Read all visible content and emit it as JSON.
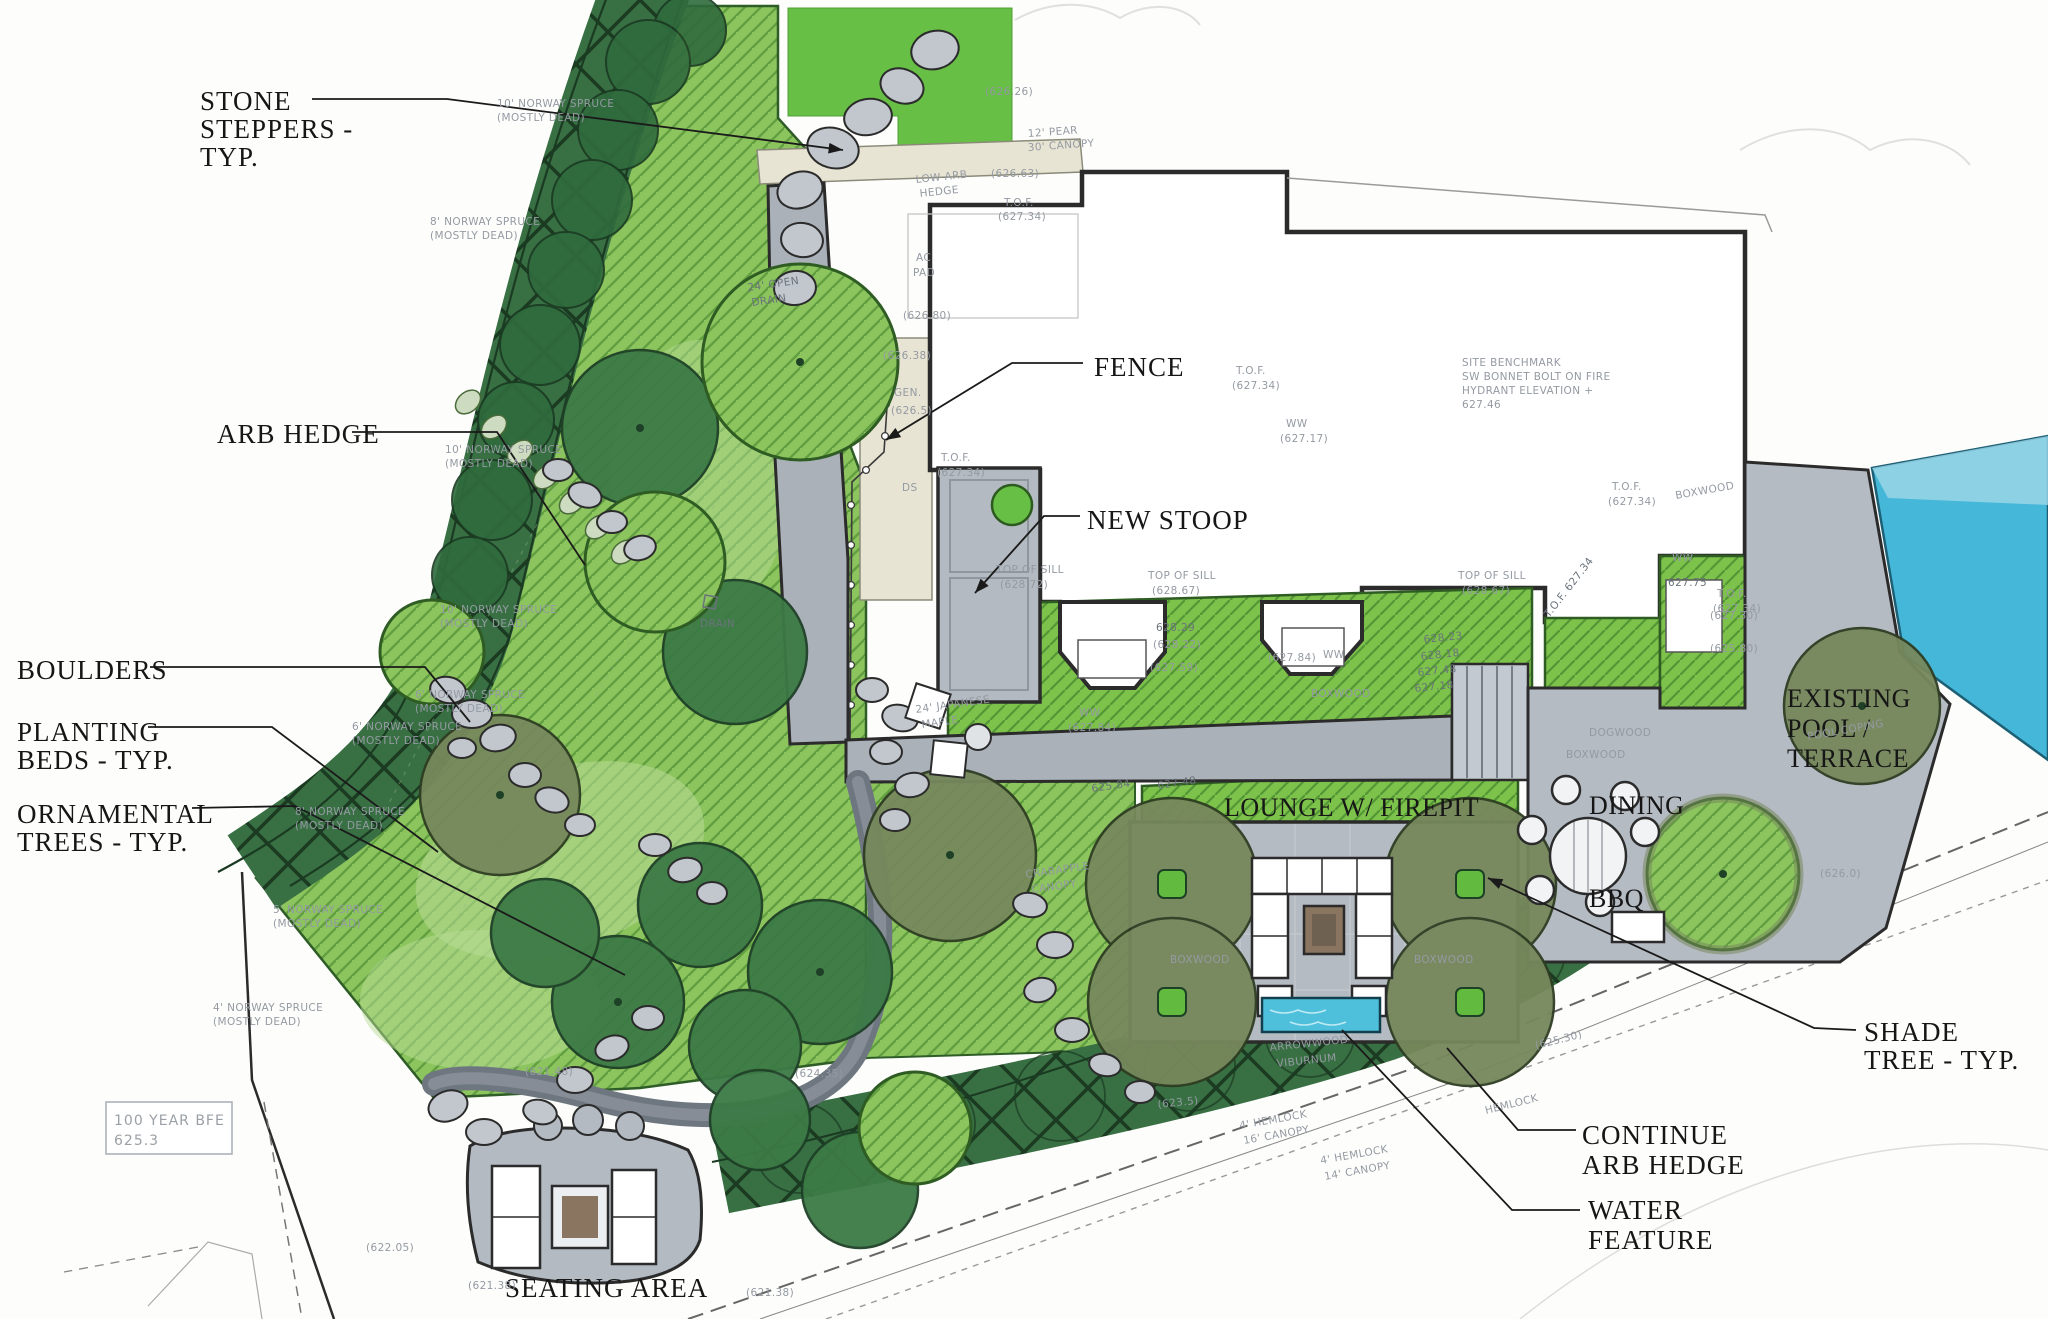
{
  "drawing": "residential landscape site plan",
  "colors": {
    "bed_green": "#8cc45e",
    "bright_bed_green": "#7dc24b",
    "lawn_green": "#67bf45",
    "hedge_green": "#387043",
    "hedge_dark": "#1b3a22",
    "tree_dark_green": "#3c7a46",
    "tree_olive": "#76885c",
    "path_grey": "#aab1b9",
    "terrace_grey": "#b5bbc3",
    "stone_grey": "#c2c7cd",
    "pool_blue": "#45b7d8",
    "water_blue": "#4fc0dc",
    "firepit_brown": "#8a7560",
    "tan": "#e8e4d3",
    "ink": "#1a1a1a",
    "note_grey": "#949aa2"
  },
  "callouts": {
    "stone_steppers": {
      "lines": [
        "STONE",
        "STEPPERS -",
        "TYP."
      ]
    },
    "arb_hedge": {
      "lines": [
        "ARB HEDGE"
      ]
    },
    "boulders": {
      "lines": [
        "BOULDERS"
      ]
    },
    "planting_beds": {
      "lines": [
        "PLANTING",
        "BEDS - TYP."
      ]
    },
    "ornamental": {
      "lines": [
        "ORNAMENTAL",
        "TREES - TYP."
      ]
    },
    "fence": {
      "lines": [
        "FENCE"
      ]
    },
    "new_stoop": {
      "lines": [
        "NEW STOOP"
      ]
    },
    "lounge": {
      "lines": [
        "LOUNGE W/ FIREPIT"
      ]
    },
    "dining": {
      "lines": [
        "DINING"
      ]
    },
    "bbq": {
      "lines": [
        "BBQ"
      ]
    },
    "pool": {
      "lines": [
        "EXISTING",
        "POOL /",
        "TERRACE"
      ]
    },
    "shade_tree": {
      "lines": [
        "SHADE",
        "TREE - TYP."
      ]
    },
    "continue_arb": {
      "lines": [
        "CONTINUE",
        "ARB HEDGE"
      ]
    },
    "water_feature": {
      "lines": [
        "WATER",
        "FEATURE"
      ]
    },
    "seating": {
      "lines": [
        "SEATING AREA"
      ]
    },
    "bfe": {
      "lines": [
        "100 YEAR BFE",
        "625.3"
      ]
    }
  },
  "annotations": {
    "norway10": "10' NORWAY SPRUCE",
    "norway8": "8' NORWAY SPRUCE",
    "norway6": "6' NORWAY SPRUCE",
    "norway5": "5' NORWAY SPRUCE",
    "norway4": "4' NORWAY SPRUCE",
    "mostly_dead": "(MOSTLY DEAD)",
    "low_arb_1": "LOW ARB",
    "low_arb_2": "HEDGE",
    "pear": "12' PEAR",
    "pear_canopy": "30' CANOPY",
    "tof": "T.O.F.",
    "tof_elev": "(627.34)",
    "tof_inline": "T.O.F. 627.34",
    "ac_1": "AC",
    "ac_2": "PAD",
    "gen": "GEN.",
    "ds": "DS",
    "top_of_sill": "TOP OF SILL",
    "sill_72": "(628.72)",
    "sill_67": "(628.67)",
    "ww": "WW",
    "e627_84": "(627.84)",
    "e627_30": "(627.30)",
    "e627_17": "(627.17)",
    "e627_75": "627.75",
    "e628_29": "628.29",
    "e628_22": "(628.22)",
    "e627_59": "(627.59)",
    "e628_23": "628.23",
    "e628_18": "628.18",
    "e627_48": "627.48",
    "e627_18": "627.18",
    "e625_84": "625.84",
    "e626_26": "(626.26)",
    "e626_63": "(626.63)",
    "e626_80": "(626.80)",
    "e626_38": "(626.38)",
    "e626_5": "(626.5)",
    "e626_0": "(626.0)",
    "e625_80": "(625.80)",
    "e623_5": "(623.5)",
    "e625_30": "(625.30)",
    "e622_05": "(622.05)",
    "e621_48": "(621.48)",
    "e621_38": "(621.38)",
    "e624_35": "(624.35)",
    "boxwood": "BOXWOOD",
    "dogwood": "DOGWOOD",
    "arrowwood_1": "ARROWWOOD",
    "arrowwood_2": "VIBURNUM",
    "hemlock": "HEMLOCK",
    "hemlock4": "4' HEMLOCK",
    "canopy14": "14' CANOPY",
    "canopy16": "16' CANOPY",
    "crab_1": "CRABAPPLE",
    "crab_2": "CANOPY",
    "jmaple_1": "24' JAPANESE",
    "jmaple_2": "MAPLE",
    "drain_1": "24' OPEN",
    "drain_2": "DRAIN",
    "drain": "DRAIN",
    "pool_coping": "POOL COPING",
    "bm_1": "SITE BENCHMARK",
    "bm_2": "SW BONNET BOLT ON FIRE",
    "bm_3": "HYDRANT ELEVATION +",
    "bm_4": "627.46"
  }
}
